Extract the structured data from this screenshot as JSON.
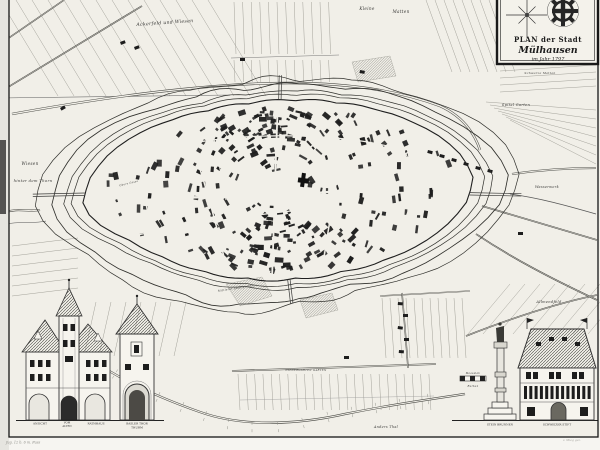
{
  "colors": {
    "paper": "#f1efe8",
    "ink": "#2b2b2b",
    "light_line": "#9a9a92",
    "water_line": "#4a4a45"
  },
  "icons": {
    "compass": "compass-rose",
    "emblem": "mulhouse-wheel"
  },
  "cartouche": {
    "title_line1": "PLAN der Stadt",
    "title_line2": "Mülhausen",
    "title_line3": "im Jahr 1797"
  },
  "map_labels": [
    {
      "text": "Ackerfeld und Wiesen",
      "x": 165,
      "y": 24,
      "size": 4.6,
      "rot": -4
    },
    {
      "text": "Kleine",
      "x": 367,
      "y": 10,
      "size": 4.2
    },
    {
      "text": "Matten",
      "x": 401,
      "y": 13,
      "size": 4.2
    },
    {
      "text": "Wiesen",
      "x": 30,
      "y": 165,
      "size": 4.2
    },
    {
      "text": "hinter dem Thorn",
      "x": 33,
      "y": 182,
      "size": 3.8
    },
    {
      "text": "Spital Garten",
      "x": 516,
      "y": 106,
      "size": 3.6
    },
    {
      "text": "Wasserwerk",
      "x": 547,
      "y": 188,
      "size": 3.4
    },
    {
      "text": "Schwarze Matten",
      "x": 540,
      "y": 74,
      "size": 3.0
    },
    {
      "text": "Allmendfeld",
      "x": 549,
      "y": 303,
      "size": 3.6
    },
    {
      "text": "Anders Thal",
      "x": 386,
      "y": 428,
      "size": 3.4
    },
    {
      "text": "NIEDERGARTEN GARTEN",
      "x": 306,
      "y": 371,
      "size": 2.6
    },
    {
      "text": "Mittlerer Stadtgraben",
      "x": 236,
      "y": 289,
      "size": 2.7,
      "rot": -9
    },
    {
      "text": "Obere Gasse",
      "x": 129,
      "y": 184,
      "size": 2.5,
      "rot": -14
    },
    {
      "text": "Maasstab",
      "x": 473,
      "y": 374,
      "size": 2.5
    },
    {
      "text": "Ruthen",
      "x": 473,
      "y": 387,
      "size": 2.5
    }
  ],
  "vignettes": {
    "rathaus": {
      "caption_1": "ANSICHT",
      "caption_2a": "VOM",
      "caption_2b": "ALTEN",
      "caption_3": "RATHHAUS"
    },
    "gate_tower": {
      "caption_1": "BASLER THOR",
      "caption_2": "THURM"
    },
    "fountain": {
      "caption": "STEIN BRUNNEN"
    },
    "house": {
      "caption": "SCHWEIZER STIFT"
    }
  },
  "annotations": {
    "plate_note": "Jug. 12 b. 6 m. Fuss",
    "artist_note": "v. Mieg gez."
  }
}
